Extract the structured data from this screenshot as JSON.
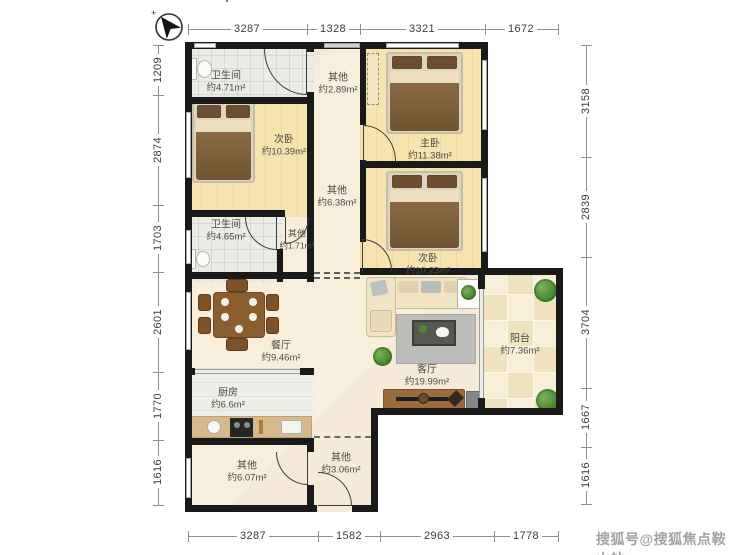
{
  "compass": {
    "name": "north-arrow"
  },
  "watermark": "搜狐号@搜狐焦点鞍山站",
  "dimensions": {
    "top": [
      "3287",
      "1328",
      "3321",
      "1672"
    ],
    "bottom": [
      "3287",
      "1582",
      "2963",
      "1778"
    ],
    "left": [
      "1209",
      "2874",
      "1703",
      "2601",
      "1770",
      "1616"
    ],
    "right": [
      "3158",
      "2839",
      "3704",
      "1667",
      "1616"
    ]
  },
  "rooms": [
    {
      "name": "卫生间",
      "area": "约4.71m²"
    },
    {
      "name": "其他",
      "area": "约2.89m²"
    },
    {
      "name": "次卧",
      "area": "约10.39m²"
    },
    {
      "name": "主卧",
      "area": "约11.38m²"
    },
    {
      "name": "其他",
      "area": "约6.38m²"
    },
    {
      "name": "卫生间",
      "area": "约4.65m²"
    },
    {
      "name": "其他",
      "area": "约1.71m²"
    },
    {
      "name": "次卧",
      "area": "约10.23m²"
    },
    {
      "name": "餐厅",
      "area": "约9.46m²"
    },
    {
      "name": "客厅",
      "area": "约19.99m²"
    },
    {
      "name": "阳台",
      "area": "约7.36m²"
    },
    {
      "name": "厨房",
      "area": "约6.6m²"
    },
    {
      "name": "其他",
      "area": "约6.07m²"
    },
    {
      "name": "其他",
      "area": "约3.06m²"
    }
  ],
  "colors": {
    "wall": "#1a1a1a",
    "bedroom_floor": "#f5e4ae",
    "cream_floor": "#f7efdc",
    "accent_wood": "#8b5e2f"
  }
}
